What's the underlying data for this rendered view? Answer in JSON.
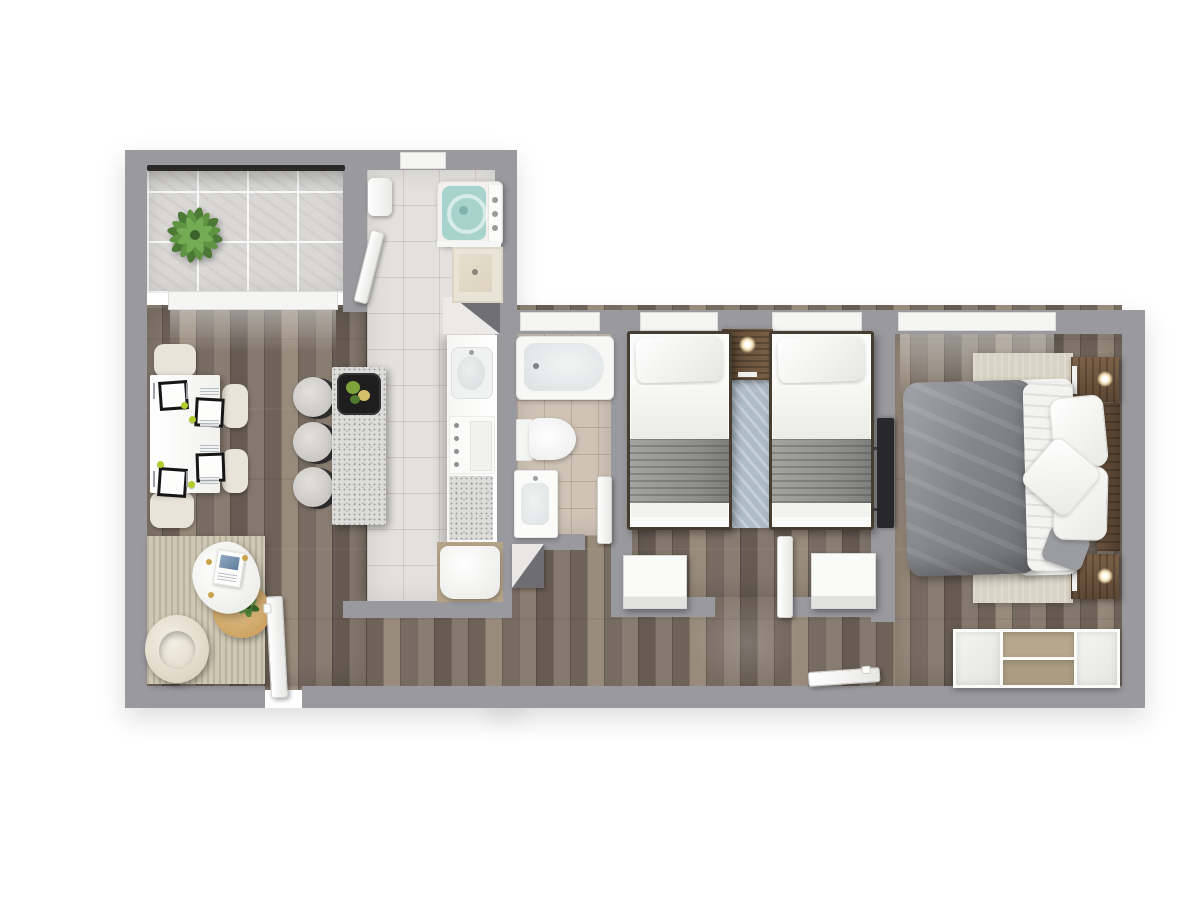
{
  "scene": {
    "kind": "apartment-floor-plan-3d-top-view",
    "rooms": [
      {
        "id": "balcony",
        "items": [
          "potted-plant",
          "glass-railing",
          "tile-floor"
        ]
      },
      {
        "id": "living-dining",
        "items": [
          "dining-table",
          "placemats",
          "dining-chairs",
          "area-rug",
          "pebble-coffee-table",
          "magazine",
          "round-side-table",
          "small-plant",
          "armchair",
          "entrance-door"
        ]
      },
      {
        "id": "kitchen",
        "items": [
          "island-counter",
          "serving-tray",
          "bar-stools",
          "counter",
          "kitchen-sink",
          "cooktop",
          "granite-worktop",
          "fridge"
        ]
      },
      {
        "id": "laundry",
        "items": [
          "top-load-washer",
          "utility-sink",
          "door"
        ]
      },
      {
        "id": "bathroom",
        "items": [
          "bathtub",
          "toilet",
          "sink-vanity",
          "door"
        ]
      },
      {
        "id": "bedroom-twin",
        "items": [
          "single-bed-left",
          "single-bed-right",
          "shared-nightstand",
          "pendant-lamp",
          "runner-rug",
          "storage-chest-left",
          "storage-chest-right",
          "door",
          "windows"
        ]
      },
      {
        "id": "bedroom-master",
        "items": [
          "double-bed",
          "gray-duvet",
          "pillows",
          "headboard",
          "nightstand-top",
          "nightstand-bottom",
          "bedside-lamps",
          "area-rug",
          "wall-tv",
          "sideboard-dresser",
          "door",
          "window"
        ]
      }
    ]
  },
  "colors": {
    "background": "#ffffff",
    "wall": "#9a999e",
    "railing_dark": "#2b2a29",
    "window": "#f5f5f4",
    "wood_floor": "#7c7268",
    "tile_kitchen": "#e3e1dd",
    "tile_balcony": "#d9d8d6",
    "tile_bathroom": "#cec3b5",
    "island_granite": "#dcdcda",
    "dining_chair": "#e9e4d9",
    "napkin_green": "#b5cc2e",
    "washer_lid": "#a7d3cc",
    "plant_green": "#57883f",
    "tray_black": "#1e1e1e",
    "rug_living": "#cfc8b4",
    "rug_twin": "#aebcc6",
    "rug_master": "#d9d3c5",
    "blanket_gray": "#8e8e8c",
    "duvet_gray": "#84868a",
    "furniture_wood": "#6f5138",
    "side_table_wood": "#d0a868",
    "dresser_tan": "#b6a78d",
    "tv_black": "#28282a",
    "lamp_glow": "#fff3d6"
  }
}
